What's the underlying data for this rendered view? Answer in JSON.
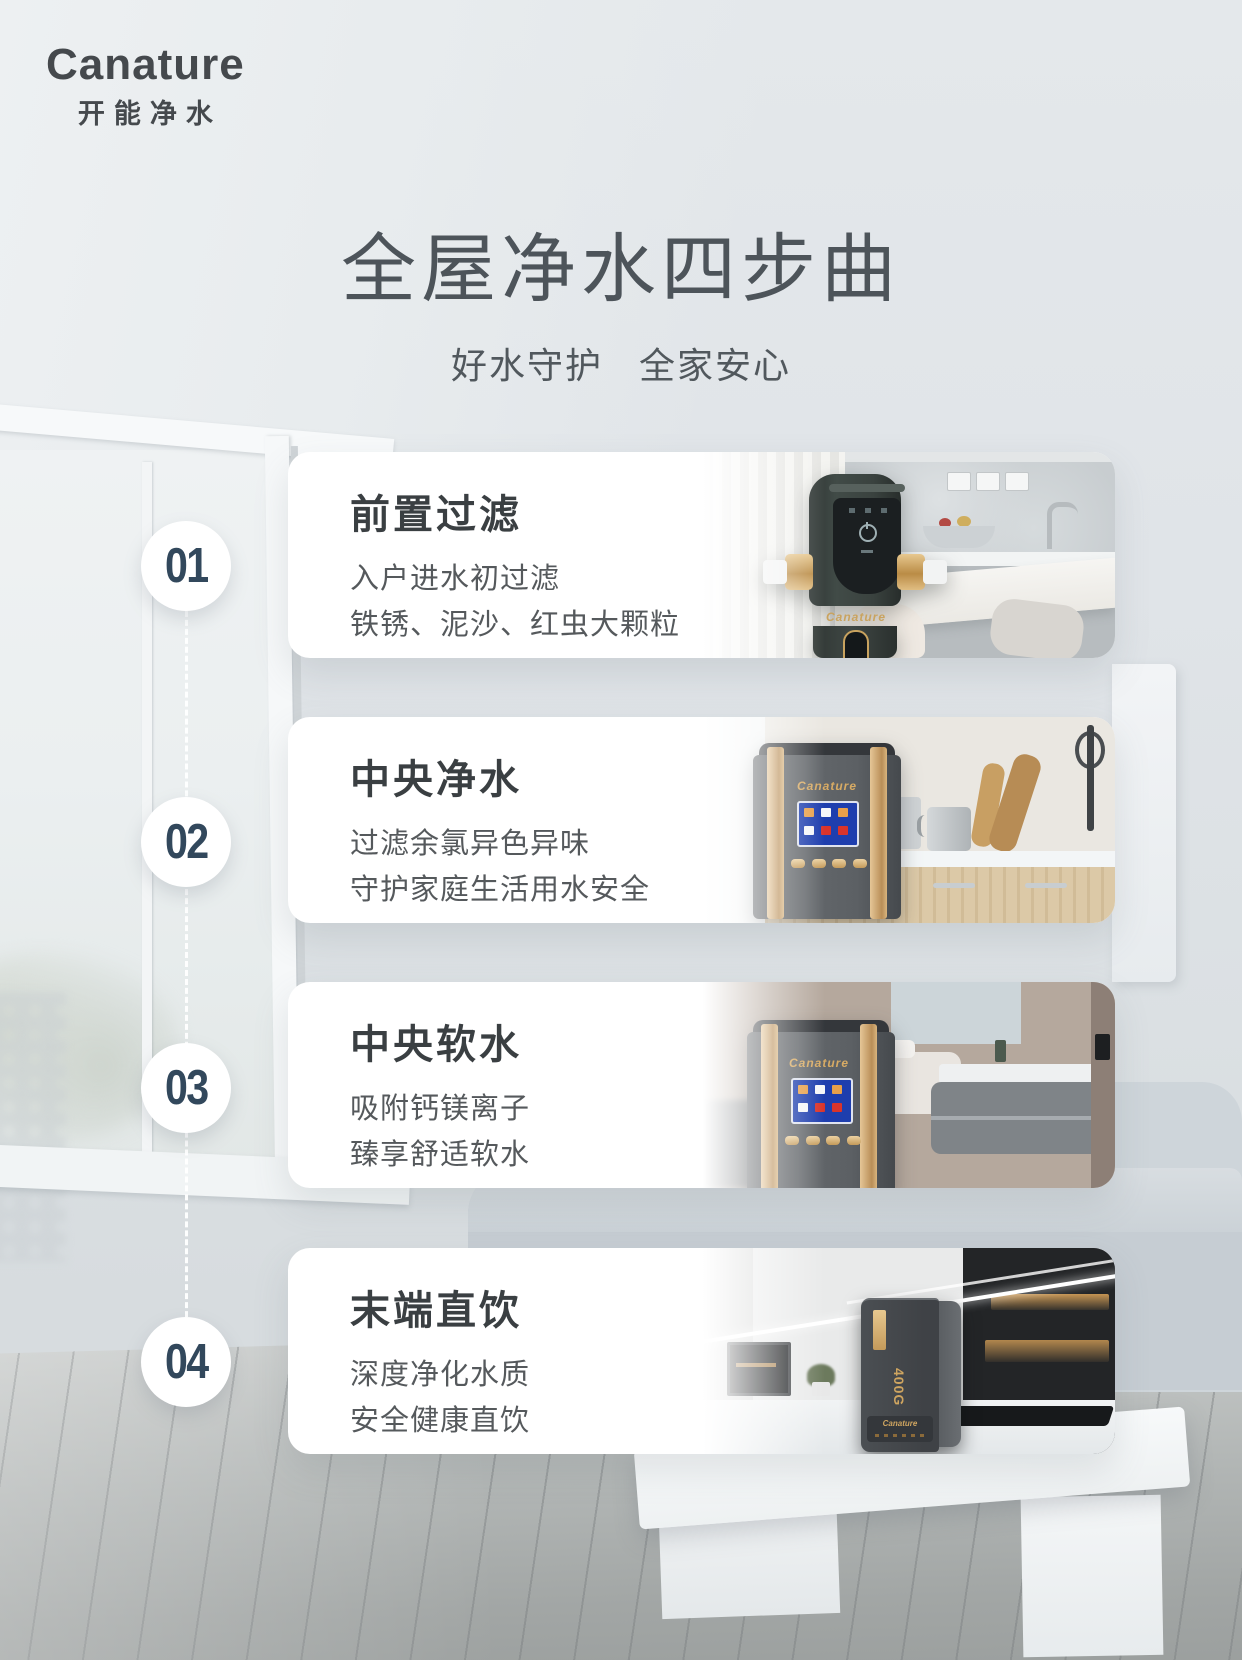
{
  "brand": {
    "name": "Canature",
    "chinese": "开能净水"
  },
  "header": {
    "title": "全屋净水四步曲",
    "subtitle": "好水守护 全家安心"
  },
  "steps": [
    {
      "number": "01",
      "title": "前置过滤",
      "line1": "入户进水初过滤",
      "line2": "铁锈、泥沙、红虫大颗粒",
      "device_label": "Canature"
    },
    {
      "number": "02",
      "title": "中央净水",
      "line1": "过滤余氯异色异味",
      "line2": "守护家庭生活用水安全",
      "device_label": "Canature"
    },
    {
      "number": "03",
      "title": "中央软水",
      "line1": "吸附钙镁离子",
      "line2": "臻享舒适软水",
      "device_label": "Canature"
    },
    {
      "number": "04",
      "title": "末端直饮",
      "line1": "深度净化水质",
      "line2": "安全健康直饮",
      "device_label": "Canature",
      "badge": "400G"
    }
  ],
  "colors": {
    "gold_accent": "#c49a5a",
    "step_number": "#32485c",
    "card_title": "#3a3f42",
    "body_text": "#55595c",
    "heading_text": "#4d545a",
    "card_background": "#ffffff"
  }
}
